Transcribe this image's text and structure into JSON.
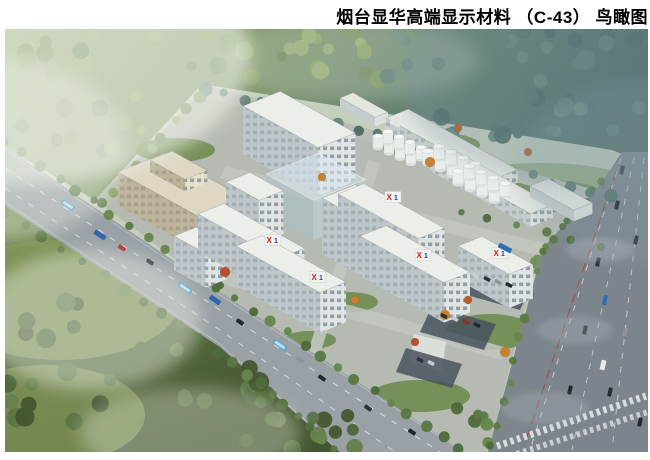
{
  "title": {
    "text": "烟台显华高端显示材料 （C-43） 鸟瞰图",
    "color": "#000000"
  },
  "figure": {
    "type": "architectural-aerial-rendering",
    "parcel_label": "C-43"
  },
  "logo": {
    "x": "X",
    "one": "1",
    "red": "#cf2318",
    "blue": "#1d41a3"
  },
  "scene": {
    "iso": {
      "u": [
        0.875,
        0.485
      ],
      "v": [
        0.93,
        -0.37
      ]
    },
    "palette": {
      "base": "#c6cfbe",
      "paving": "#b5bbb2",
      "lawn": "#6f8c50",
      "parking": "#49545f",
      "building": {
        "white": {
          "roof": "#eceee9",
          "sw": "#bfc7ca",
          "se": "#e0e5e4"
        },
        "beige": {
          "roof": "#ddd7c3",
          "sw": "#bdb49a",
          "se": "#e8e1cc"
        },
        "shop": {
          "roof": "#e4e7e1",
          "sw": "#c6cdcd",
          "se": "#dce1dd"
        },
        "ghost": {
          "roof": "rgba(216,232,238,0.55)",
          "sw": "rgba(168,192,202,0.5)",
          "se": "rgba(194,215,222,0.55)"
        }
      },
      "tank": {
        "body": "#e9edeb",
        "top": "#f6f8f6",
        "shadow": "#dde2df",
        "stroke": "#c8cfcb"
      },
      "pal_tl": [
        "#87a063",
        "#76905a",
        "#93ab72",
        "#6a8455"
      ],
      "pal_tr": [
        "#5e7d74",
        "#54746e",
        "#688578",
        "#4c6a66"
      ],
      "pal_b": [
        "#4e6639",
        "#5b7544",
        "#44562f",
        "#66804c"
      ],
      "pal_rs": [
        "#5a7742",
        "#4e6a3a",
        "#68854d"
      ]
    },
    "regions": {
      "forest_top": "5,29 648,29 648,164 612,150 202,84 95,200 5,147",
      "forest_bottom": "5,205 220,347 340,452 5,452",
      "campus": "95,200 202,92 610,208 540,250 488,452 465,452 220,292",
      "meadows": [
        [
          60,
          300,
          120,
          60,
          "#7e9355",
          0.85
        ],
        [
          45,
          415,
          100,
          50,
          "#879a5c",
          0.7
        ],
        [
          540,
          185,
          95,
          22,
          "#8aa26b",
          0.75
        ]
      ]
    },
    "lawns": [
      [
        175,
        150,
        40,
        12
      ],
      [
        300,
        133,
        45,
        12
      ],
      [
        430,
        145,
        50,
        13
      ],
      [
        545,
        196,
        60,
        16
      ],
      [
        490,
        332,
        45,
        18
      ],
      [
        420,
        396,
        50,
        16
      ],
      [
        200,
        212,
        32,
        10
      ],
      [
        560,
        262,
        30,
        12
      ],
      [
        350,
        302,
        28,
        10
      ],
      [
        310,
        340,
        26,
        9
      ]
    ],
    "paths": [
      {
        "pts": "202,84 618,196 612,208 198,96",
        "fill": "#b9bfb8",
        "op": 1
      },
      {
        "pts": "308,352 368,160 380,164 320,354",
        "fill": "#c2c7c0",
        "op": 0.9
      },
      {
        "pts": "190,262 508,348 502,360 186,274",
        "fill": "#c2c7c0",
        "op": 0.85
      },
      {
        "pts": "226,166 598,256 592,268 220,178",
        "fill": "#c2c7c0",
        "op": 0.85
      },
      {
        "pts": "536,295 606,312 602,324 532,307",
        "fill": "#c3c8c1",
        "op": 0.9
      },
      {
        "pts": "414,334 446,342 442,372 410,362",
        "fill": "#dfe3dd",
        "op": 0.9
      }
    ],
    "roads": {
      "front": {
        "pts": "5,147 220,292 465,452 340,452 220,347 5,205",
        "fill": "#9aa1a6"
      },
      "right": {
        "pts": "622,152 648,152 648,452 488,452 543,248 600,185",
        "fill": "#7d858c"
      }
    },
    "markings": [
      {
        "pts": "5,168 220,310 440,452",
        "w": 1,
        "dash": "6 8",
        "color": "#eef1f2",
        "op": 0.75
      },
      {
        "pts": "5,188 220,330 395,452",
        "w": 1,
        "dash": "6 8",
        "color": "#eef1f2",
        "op": 0.7
      },
      {
        "pts": "5,150 220,295 460,450",
        "w": 0.8,
        "dash": "",
        "color": "#dfe3e4",
        "op": 0.45
      },
      {
        "pts": "5,202 220,344 338,450",
        "w": 0.8,
        "dash": "",
        "color": "#dfe3e4",
        "op": 0.45
      },
      {
        "pts": "621,158 530,450",
        "w": 1,
        "dash": "6 8",
        "color": "#eef1f2",
        "op": 0.65
      },
      {
        "pts": "634,158 572,450",
        "w": 1,
        "dash": "6 8",
        "color": "#eef1f2",
        "op": 0.6
      },
      {
        "pts": "644,158 612,450",
        "w": 1,
        "dash": "6 8",
        "color": "#eef1f2",
        "op": 0.6
      },
      {
        "pts": "616,172 524,446",
        "w": 1,
        "dash": "10 6",
        "color": "#b3382e",
        "op": 0.8
      },
      {
        "pts": "497,446 646,396",
        "w": 7,
        "dash": "3.5 3.5",
        "color": "#e8ecee",
        "op": 0.85
      },
      {
        "pts": "510,456 648,412",
        "w": 6,
        "dash": "3.5 3.5",
        "color": "#e8ecee",
        "op": 0.7
      }
    ],
    "parking": [
      "468,266 532,284 520,310 456,292",
      "432,306 496,324 484,350 420,332",
      "406,348 462,364 452,388 396,372"
    ],
    "tree_clusters": [
      {
        "x": 5,
        "y": 30,
        "w": 380,
        "h": 52,
        "n": 30,
        "rmin": 5,
        "rmax": 10,
        "pal": "pal_tl",
        "seed": 1
      },
      {
        "x": 385,
        "y": 30,
        "w": 260,
        "h": 56,
        "n": 20,
        "rmin": 5,
        "rmax": 10,
        "pal": "pal_tr",
        "seed": 2
      },
      {
        "x": 430,
        "y": 88,
        "w": 210,
        "h": 50,
        "n": 20,
        "rmin": 5,
        "rmax": 9,
        "pal": "pal_tr",
        "seed": 3
      },
      {
        "x": 5,
        "y": 82,
        "w": 145,
        "h": 70,
        "n": 14,
        "rmin": 5,
        "rmax": 9,
        "pal": "pal_tl",
        "seed": 4
      },
      {
        "x": 5,
        "y": 285,
        "w": 115,
        "h": 160,
        "n": 16,
        "rmin": 6,
        "rmax": 11,
        "pal": "pal_b",
        "seed": 5
      },
      {
        "x": 115,
        "y": 345,
        "w": 155,
        "h": 100,
        "n": 15,
        "rmin": 6,
        "rmax": 11,
        "pal": "pal_b",
        "seed": 6
      },
      {
        "x": 255,
        "y": 415,
        "w": 100,
        "h": 35,
        "n": 10,
        "rmin": 5,
        "rmax": 9,
        "pal": "pal_b",
        "seed": 7
      },
      {
        "x": 452,
        "y": 400,
        "w": 42,
        "h": 45,
        "n": 6,
        "rmin": 4,
        "rmax": 7,
        "pal": "pal_rs",
        "seed": 8
      }
    ],
    "tree_lines": [
      {
        "x1": 5,
        "y1": 140,
        "x2": 218,
        "y2": 287,
        "n": 13,
        "rmin": 3.5,
        "rmax": 6,
        "pal": "pal_rs",
        "seed": 11
      },
      {
        "x1": 218,
        "y1": 287,
        "x2": 460,
        "y2": 447,
        "n": 15,
        "rmin": 3.5,
        "rmax": 6,
        "pal": "pal_rs",
        "seed": 12
      },
      {
        "x1": 5,
        "y1": 212,
        "x2": 220,
        "y2": 352,
        "n": 12,
        "rmin": 3.5,
        "rmax": 6,
        "pal": "pal_rs",
        "seed": 13
      },
      {
        "x1": 220,
        "y1": 352,
        "x2": 335,
        "y2": 450,
        "n": 10,
        "rmin": 3.5,
        "rmax": 6,
        "pal": "pal_rs",
        "seed": 14
      },
      {
        "x1": 600,
        "y1": 180,
        "x2": 545,
        "y2": 248,
        "n": 8,
        "rmin": 3,
        "rmax": 5,
        "pal": "pal_rs",
        "seed": 15
      },
      {
        "x1": 542,
        "y1": 252,
        "x2": 492,
        "y2": 446,
        "n": 10,
        "rmin": 3,
        "rmax": 5,
        "pal": "pal_rs",
        "seed": 16
      },
      {
        "x1": 205,
        "y1": 88,
        "x2": 610,
        "y2": 196,
        "n": 22,
        "rmin": 4,
        "rmax": 7,
        "pal": "pal_tr",
        "seed": 17
      },
      {
        "x1": 100,
        "y1": 205,
        "x2": 200,
        "y2": 95,
        "n": 9,
        "rmin": 4,
        "rmax": 7,
        "pal": "pal_tl",
        "seed": 18
      },
      {
        "x1": 462,
        "y1": 212,
        "x2": 600,
        "y2": 248,
        "n": 6,
        "rmin": 3,
        "rmax": 5,
        "pal": "pal_rs",
        "seed": 19
      }
    ],
    "buildings_back": [
      {
        "t": "beige",
        "x": 118,
        "y": 172,
        "len": 98,
        "dep": 50,
        "h": 34
      },
      {
        "t": "beige",
        "x": 150,
        "y": 160,
        "len": 40,
        "dep": 24,
        "h": 12
      },
      {
        "t": "white",
        "x": 243,
        "y": 106,
        "len": 86,
        "dep": 40,
        "h": 48
      },
      {
        "t": "shop",
        "x": 340,
        "y": 98,
        "len": 40,
        "dep": 14,
        "h": 9
      },
      {
        "t": "shop",
        "x": 386,
        "y": 118,
        "len": 125,
        "dep": 24,
        "h": 13
      },
      {
        "t": "shop",
        "x": 430,
        "y": 158,
        "len": 115,
        "dep": 24,
        "h": 13
      },
      {
        "t": "shop",
        "x": 530,
        "y": 186,
        "len": 50,
        "dep": 20,
        "h": 11
      }
    ],
    "tanks": [
      {
        "x": 378,
        "y": 148,
        "cols": 4,
        "rows": 2,
        "r": 5,
        "h": 12
      },
      {
        "x": 428,
        "y": 164,
        "cols": 4,
        "rows": 2,
        "r": 5.5,
        "h": 13
      },
      {
        "x": 458,
        "y": 184,
        "cols": 4,
        "rows": 2,
        "r": 5.5,
        "h": 13
      }
    ],
    "buildings_front": [
      {
        "t": "ghost",
        "x": 266,
        "y": 174,
        "len": 54,
        "dep": 56,
        "h": 40
      },
      {
        "t": "white",
        "x": 226,
        "y": 182,
        "len": 38,
        "dep": 26,
        "h": 44
      },
      {
        "t": "white",
        "x": 322,
        "y": 198,
        "len": 75,
        "dep": 36,
        "h": 56
      },
      {
        "t": "white",
        "x": 174,
        "y": 236,
        "len": 36,
        "dep": 24,
        "h": 34
      },
      {
        "t": "white",
        "x": 198,
        "y": 214,
        "len": 92,
        "dep": 28,
        "h": 38
      },
      {
        "t": "white",
        "x": 338,
        "y": 194,
        "len": 92,
        "dep": 28,
        "h": 38
      },
      {
        "t": "white",
        "x": 458,
        "y": 246,
        "len": 58,
        "dep": 26,
        "h": 34
      },
      {
        "t": "white",
        "x": 360,
        "y": 236,
        "len": 96,
        "dep": 28,
        "h": 40
      },
      {
        "t": "white",
        "x": 236,
        "y": 246,
        "len": 96,
        "dep": 28,
        "h": 40
      }
    ],
    "logos": [
      [
        270,
        243
      ],
      [
        390,
        200
      ],
      [
        315,
        280
      ],
      [
        420,
        258
      ],
      [
        497,
        256
      ]
    ],
    "accent_trees": [
      [
        445,
        315,
        5,
        "#c8812f"
      ],
      [
        468,
        300,
        4,
        "#b55f27"
      ],
      [
        430,
        162,
        5,
        "#c8812f"
      ],
      [
        528,
        152,
        4,
        "#b55f27"
      ],
      [
        225,
        272,
        5,
        "#b94f31"
      ],
      [
        322,
        177,
        4,
        "#c8812f"
      ],
      [
        458,
        128,
        4,
        "#b55f27"
      ],
      [
        355,
        300,
        4,
        "#c8812f"
      ],
      [
        505,
        352,
        5,
        "#c8812f"
      ],
      [
        415,
        342,
        4,
        "#b94f31"
      ]
    ],
    "vehicles": [
      [
        68,
        205,
        34,
        14,
        5,
        "#3f9fd0",
        1
      ],
      [
        100,
        235,
        34,
        13,
        5,
        "#2e66b0",
        0
      ],
      [
        122,
        248,
        34,
        8,
        4,
        "#b03028",
        0
      ],
      [
        150,
        262,
        34,
        8,
        4,
        "#2b3238",
        0
      ],
      [
        185,
        288,
        34,
        15,
        5,
        "#3f9fd0",
        1
      ],
      [
        215,
        300,
        34,
        12,
        5,
        "#2e66b0",
        0
      ],
      [
        240,
        322,
        34,
        8,
        4,
        "#23282e",
        0
      ],
      [
        280,
        345,
        34,
        15,
        5,
        "#46a5d4",
        1
      ],
      [
        300,
        360,
        34,
        8,
        4,
        "#8e9298",
        0
      ],
      [
        322,
        378,
        34,
        8,
        4,
        "#23282e",
        0
      ],
      [
        368,
        408,
        34,
        8,
        4,
        "#2b3238",
        0
      ],
      [
        412,
        432,
        34,
        8,
        4,
        "#1f2429",
        0
      ],
      [
        622,
        170,
        103,
        9,
        4,
        "#2b3238",
        0
      ],
      [
        617,
        205,
        103,
        9,
        4,
        "#23282e",
        0
      ],
      [
        636,
        240,
        103,
        9,
        4,
        "#2b3238",
        0
      ],
      [
        598,
        262,
        103,
        9,
        4,
        "#23282e",
        0
      ],
      [
        605,
        300,
        103,
        10,
        4,
        "#2f6db5",
        0
      ],
      [
        585,
        330,
        103,
        9,
        4,
        "#23282e",
        0
      ],
      [
        625,
        332,
        103,
        9,
        4,
        "#8e9298",
        0
      ],
      [
        570,
        390,
        103,
        9,
        4,
        "#23282e",
        0
      ],
      [
        610,
        392,
        103,
        9,
        4,
        "#262b30",
        0
      ],
      [
        640,
        422,
        103,
        9,
        4,
        "#23282e",
        0
      ],
      [
        603,
        365,
        103,
        10,
        5,
        "#e8eaec",
        0
      ],
      [
        505,
        248,
        27,
        14,
        5,
        "#2f6db5",
        0
      ],
      [
        395,
        124,
        27,
        11,
        4,
        "#e2e4e6",
        0
      ],
      [
        476,
        276,
        27,
        7,
        3.5,
        "#c9ced2",
        0
      ],
      [
        487,
        279,
        27,
        7,
        3.5,
        "#2b3238",
        0
      ],
      [
        498,
        282,
        27,
        7,
        3.5,
        "#8e959b",
        0
      ],
      [
        509,
        285,
        27,
        7,
        3.5,
        "#23282e",
        0
      ],
      [
        444,
        316,
        27,
        7,
        3.5,
        "#2b3238",
        0
      ],
      [
        455,
        319,
        27,
        7,
        3.5,
        "#c9ced2",
        0
      ],
      [
        466,
        322,
        27,
        7,
        3.5,
        "#8e2f2a",
        0
      ],
      [
        477,
        325,
        27,
        7,
        3.5,
        "#23282e",
        0
      ],
      [
        420,
        360,
        27,
        7,
        3.5,
        "#2b3238",
        0
      ],
      [
        431,
        363,
        27,
        7,
        3.5,
        "#c9ced2",
        0
      ]
    ],
    "haze": [
      [
        20,
        55,
        230,
        130,
        "#f2f4ec",
        0.6,
        "soft"
      ],
      [
        5,
        150,
        120,
        90,
        "#eef1e8",
        0.4,
        "soft"
      ],
      [
        90,
        320,
        110,
        70,
        "#edf0e6",
        0.45,
        "soft"
      ],
      [
        190,
        432,
        110,
        45,
        "#e8ecdf",
        0.35,
        "soft"
      ],
      [
        350,
        60,
        130,
        40,
        "#dfe7d8",
        0.25,
        "soft"
      ],
      [
        610,
        80,
        210,
        110,
        "#7e98a2",
        0.3,
        "soft"
      ],
      [
        648,
        170,
        130,
        90,
        "#8aa3ab",
        0.22,
        "soft"
      ],
      [
        600,
        250,
        34,
        12,
        "#a9b3b9",
        0.4,
        "soft3"
      ],
      [
        575,
        330,
        38,
        14,
        "#a9b3b9",
        0.35,
        "soft3"
      ],
      [
        545,
        408,
        44,
        16,
        "#adb6bc",
        0.3,
        "soft3"
      ]
    ]
  }
}
